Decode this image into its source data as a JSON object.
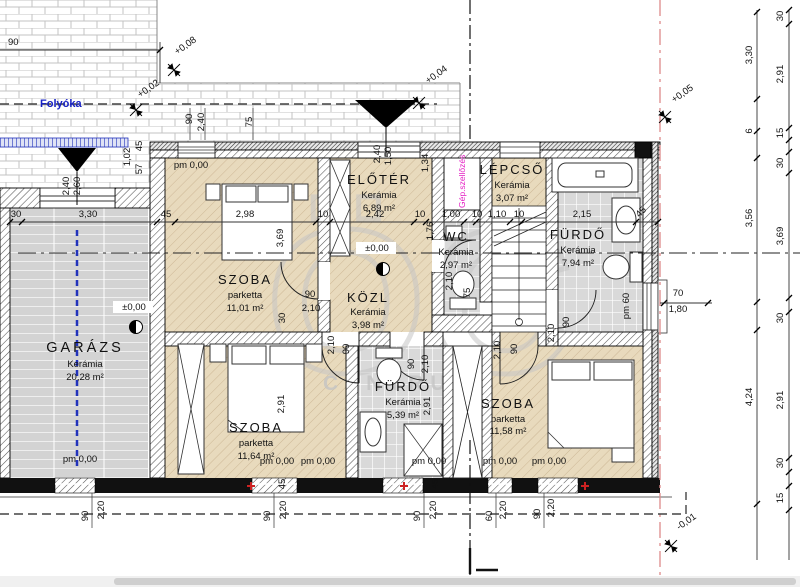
{
  "labels": {
    "folyoka": "Folyóka",
    "vent": "Gép.szellőzés"
  },
  "watermark": {
    "monogram": "ÖC",
    "text": "CENTRUM"
  },
  "rooms": [
    {
      "name": "GARÁZS",
      "material": "Kerámia",
      "area": "20,28 m²"
    },
    {
      "name": "SZOBA",
      "material": "parketta",
      "area": "11,01 m²"
    },
    {
      "name": "ELŐTÉR",
      "material": "Kerámia",
      "area": "6,89 m²"
    },
    {
      "name": "LÉPCSŐ",
      "material": "Kerámia",
      "area": "3,07 m²"
    },
    {
      "name": "WC",
      "material": "Kerámia",
      "area": "2,97 m²"
    },
    {
      "name": "FÜRDŐ",
      "material": "Kerámia",
      "area": "7,94 m²"
    },
    {
      "name": "KÖZL",
      "material": "Kerámia",
      "area": "3,98 m²"
    },
    {
      "name": "SZOBA",
      "material": "parketta",
      "area": "11,64 m²"
    },
    {
      "name": "FÜRDŐ",
      "material": "Kerámia",
      "area": "5,39 m²"
    },
    {
      "name": "SZOBA",
      "material": "parketta",
      "area": "11,58 m²"
    }
  ],
  "levels": {
    "markers": [
      "+0,08",
      "+0,02",
      "+0,04",
      "+0,05",
      "-0,01"
    ],
    "zero1": "±0,00",
    "zero2": "±0,00"
  },
  "dims": {
    "partial_left": "90",
    "mid_chain": [
      "30",
      "3,30",
      "45",
      "2,98",
      "10",
      "2,42",
      "10",
      "1,00",
      "10",
      "1,10",
      "10",
      "2,15",
      "45"
    ],
    "right_inner": [
      "3,30",
      "6",
      "3,56",
      "4,24"
    ],
    "right_outer": [
      "30",
      "2,91",
      "15",
      "30",
      "3,69",
      "30",
      "2,91",
      "30",
      "15"
    ],
    "bottom": [
      "90",
      "2,20",
      "90",
      "2,20",
      "90",
      "2,20",
      "60",
      "2,20",
      "90",
      "2,20",
      "45",
      "45"
    ],
    "doors": [
      "90",
      "2,10",
      "30",
      "2,10",
      "90",
      "90",
      "2,10",
      "2,10",
      "75",
      "2,10",
      "90",
      "2,10",
      "90"
    ],
    "windows": [
      "90",
      "2,40",
      "75",
      "1,02",
      "45",
      "57",
      "2,40",
      "2,60",
      "2,40",
      "1,50",
      "1,34",
      "1,76",
      "70",
      "1,80",
      "3,69",
      "2,91",
      "2,91"
    ],
    "pm": [
      "pm 0,00",
      "pm 0,00",
      "pm 0,00",
      "pm 0,00",
      "pm 0,00",
      "pm 0,00",
      "pm 0,00",
      "pm 60"
    ]
  },
  "colors": {
    "axis_red": "#dd8a8a",
    "drain_blue": "#2233bb",
    "vent_magenta": "#e51fc4",
    "floor_wood": "#e8dabd",
    "floor_tile": "#d9d9d9"
  }
}
